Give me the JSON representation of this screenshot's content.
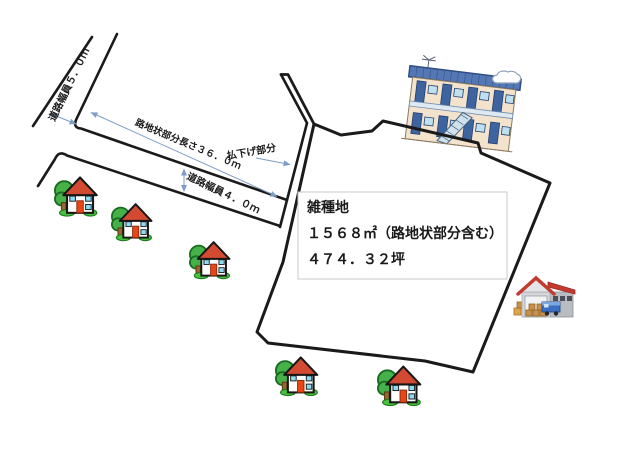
{
  "plan": {
    "labels": {
      "road_width_5m": "道路幅員５．０ｍ",
      "alley_length_36m": "路地状部分長さ３６．０ｍ",
      "road_width_4m": "道路幅員４．０ｍ",
      "setback_portion": "払下げ部分"
    },
    "info_box": {
      "land_category": "雑種地",
      "area_sqm": "１５６８㎡（路地状部分含む）",
      "area_tsubo": "４７４．３２坪"
    },
    "colors": {
      "boundary_line": "#1a1a1a",
      "dimension_arrow": "#7d9ec7",
      "info_box_border": "#c9c9c9",
      "house_roof": "#d24a32",
      "apartment_roof_blue": "#5577b3",
      "warehouse_roof_red": "#c23b31",
      "tree_green": "#46b049"
    },
    "icons": {
      "house_icon_count": 5,
      "icon_names": [
        "house-icon",
        "apartment-building-icon",
        "cloud-icon",
        "tv-antenna-icon",
        "warehouse-icon",
        "truck-icon"
      ]
    }
  }
}
